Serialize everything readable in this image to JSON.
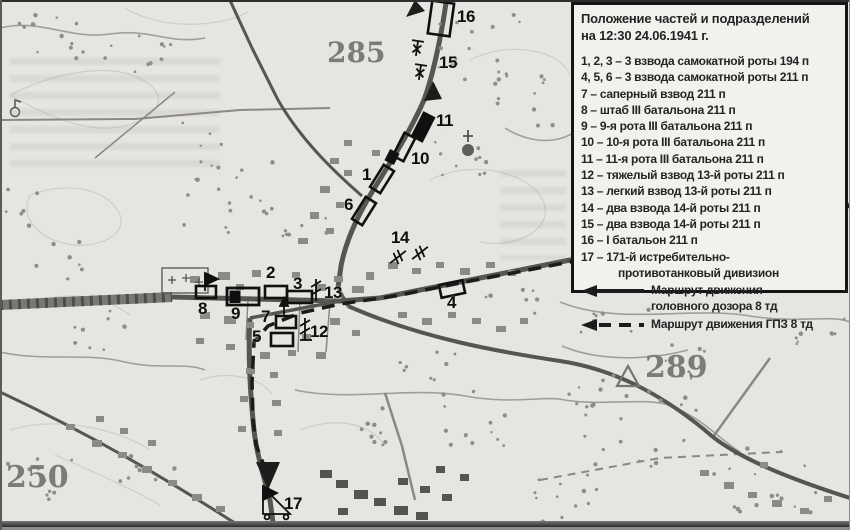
{
  "legend": {
    "title_line1": "Положение частей и подразделений",
    "title_line2": "на 12:30 24.06.1941 г.",
    "items": [
      "1, 2, 3 – 3 взвода самокатной роты 194 п",
      "4, 5, 6 – 3 взвода самокатной роты 211 п",
      "7 – саперный взвод 211 п",
      "8 –  штаб III батальона 211 п",
      "9 – 9-я рота III батальона 211 п",
      "10 – 10-я рота III батальона 211 п",
      "11 – 11-я рота III батальона 211 п",
      "12 – тяжелый взвод 13-й роты 211 п",
      "13 – легкий взвод 13-й роты 211 п",
      "14 – два взвода 14-й роты 211 п",
      "15 – два взвода 14-й роты 211 п",
      "16 – I батальон 211 п",
      "17 – 171-й истребительно-",
      "противотанковый дивизион"
    ],
    "routes": {
      "solid_line1": "Маршрут движения",
      "solid_line2": "головного дозора 8 тд",
      "dashed_line1": "Маршрут движения ГПЗ 8 тд"
    }
  },
  "map": {
    "markers": {
      "m1": "1",
      "m2": "2",
      "m3": "3",
      "m4": "4",
      "m5": "5",
      "m6": "6",
      "m7": "7",
      "m8": "8",
      "m9": "9",
      "m10": "10",
      "m11": "11",
      "m12": "12",
      "m13": "13",
      "m14": "14",
      "m15": "15",
      "m16": "16",
      "m17": "17"
    },
    "elevations": {
      "e285": "285",
      "e289": "289",
      "e250": "250"
    },
    "colors": {
      "paper": "#e7e5e1",
      "ink": "#151515",
      "map_gray": "#57554f",
      "legend_bg": "#f2f1ee"
    }
  }
}
